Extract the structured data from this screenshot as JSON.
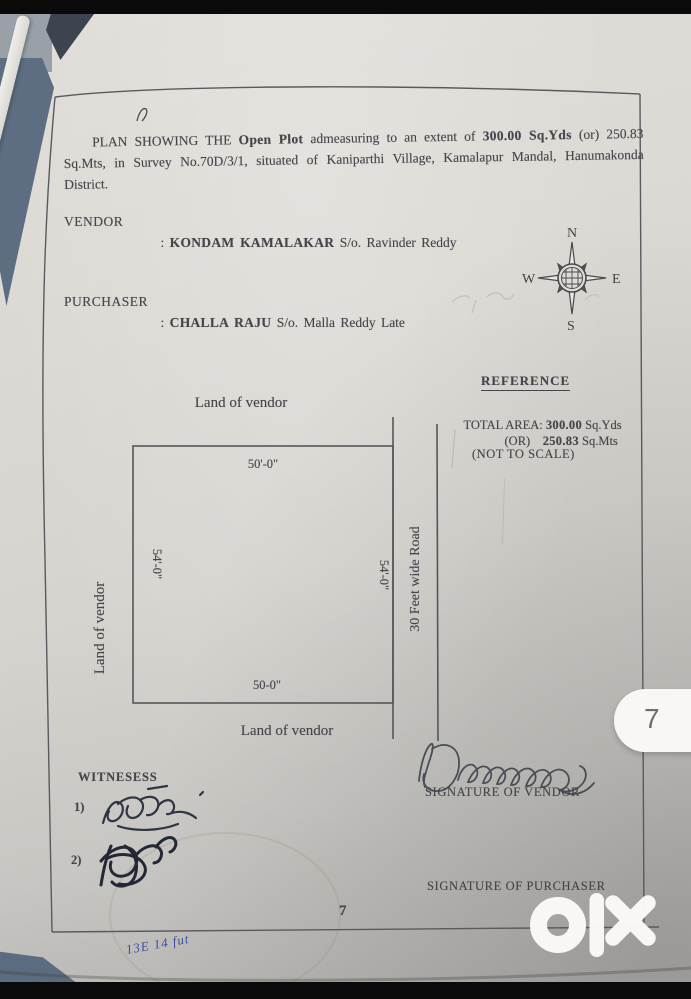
{
  "viewer": {
    "page_badge": "7",
    "watermark": "olx"
  },
  "document": {
    "title": {
      "part1": "PLAN SHOWING THE ",
      "bold1": "Open Plot",
      "part2": " admeasuring to an extent of ",
      "bold2": "300.00 Sq.Yds",
      "part3": " (or) 250.83 Sq.Mts, in Survey No.70D/3/1, situated of Kaniparthi Village, Kamalapur Mandal, Hanumakonda District."
    },
    "parties": {
      "vendor_label": "VENDOR",
      "vendor_colon": ": ",
      "vendor_name": "KONDAM KAMALAKAR",
      "vendor_rest": " S/o. Ravinder Reddy",
      "purchaser_label": "PURCHASER",
      "purchaser_colon": ": ",
      "purchaser_name": "CHALLA RAJU",
      "purchaser_rest": " S/o. Malla Reddy Late"
    },
    "compass": {
      "n": "N",
      "s": "S",
      "e": "E",
      "w": "W"
    },
    "reference": {
      "heading": "REFERENCE",
      "total_label": "TOTAL AREA: ",
      "total_value": "300.00",
      "total_unit": " Sq.Yds",
      "or_label": "(OR)    ",
      "alt_value": "250.83",
      "alt_unit": " Sq.Mts",
      "scale_note": "(NOT TO SCALE)"
    },
    "plot": {
      "north_label": "Land of vendor",
      "west_label": "Land of vendor",
      "south_label": "Land of vendor",
      "road_label": "30 Feet wide Road",
      "dim_top": "50'-0\"",
      "dim_bottom": "50-0\"",
      "dim_left": "54'-0\"",
      "dim_right": "54'-0\""
    },
    "signatures": {
      "witness_heading": "WITNESESS",
      "witness_1": "1)",
      "witness_2": "2)",
      "vendor_caption": "SIGNATURE OF VENDOR",
      "purchaser_caption": "SIGNATURE OF PURCHASER"
    },
    "page_number": "7",
    "handwritten_note": "13E 14 fut"
  },
  "colors": {
    "accent_blue_ink": "#3b4fa0",
    "paper": "#d8d6d1",
    "background_surface": "#5d6e82"
  }
}
